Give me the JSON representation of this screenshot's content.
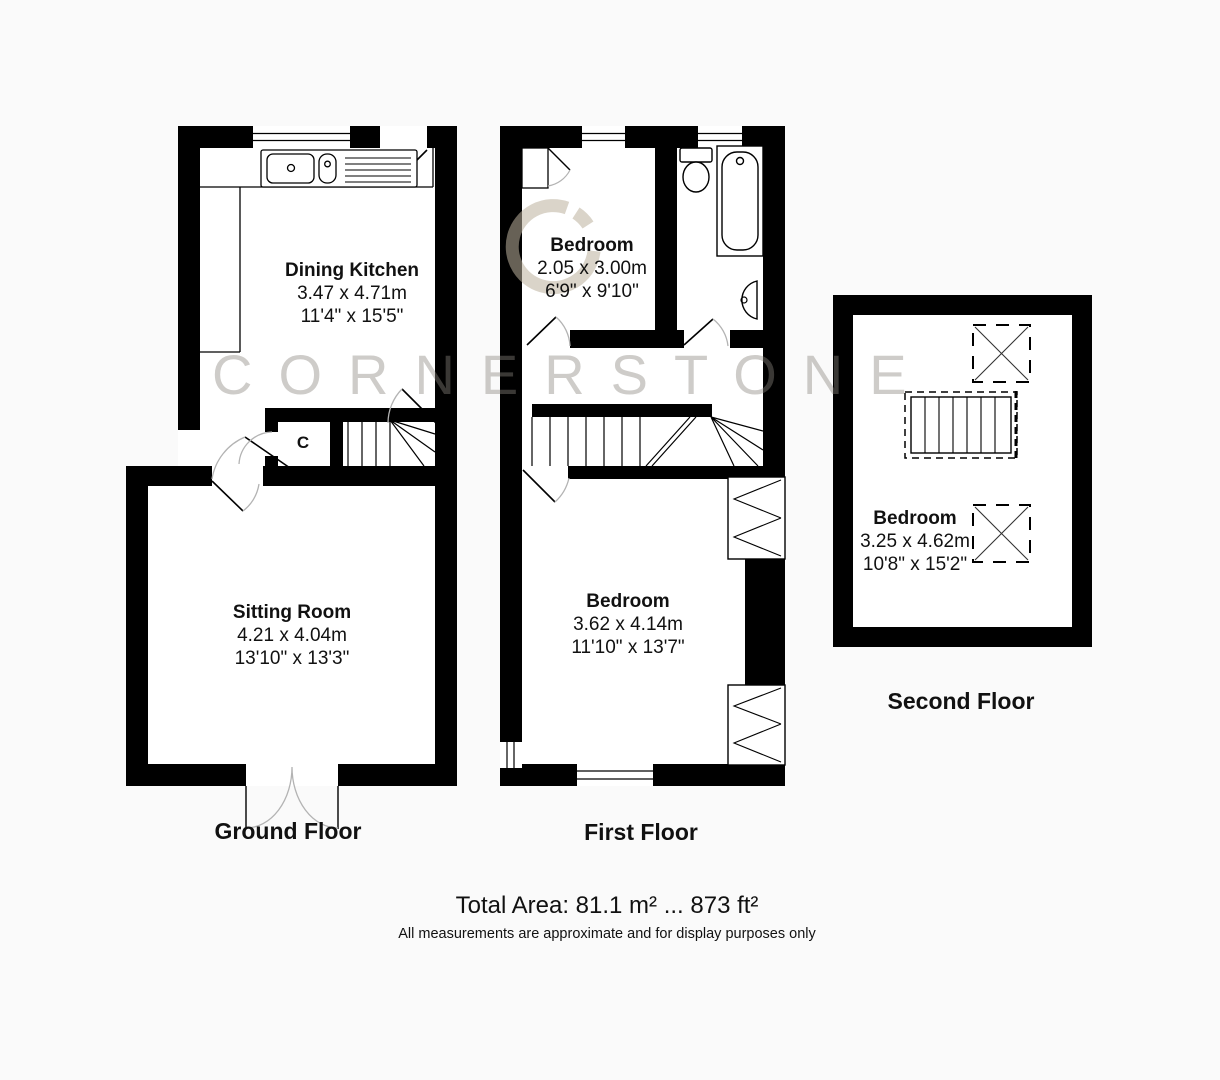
{
  "watermark": {
    "text": "CORNERSTONE"
  },
  "brand_colors": {
    "watermark_gray": "#cfcdc9",
    "logo_tan": "#dbd4c8",
    "wall_black": "#000000"
  },
  "floors": {
    "ground": {
      "title": "Ground Floor",
      "closet_label": "C",
      "rooms": [
        {
          "name": "Dining Kitchen",
          "metric": "3.47 x 4.71m",
          "imperial": "11'4\" x 15'5\""
        },
        {
          "name": "Sitting Room",
          "metric": "4.21 x 4.04m",
          "imperial": "13'10\" x 13'3\""
        }
      ]
    },
    "first": {
      "title": "First Floor",
      "rooms": [
        {
          "name": "Bedroom",
          "metric": "2.05 x 3.00m",
          "imperial": "6'9\" x 9'10\""
        },
        {
          "name": "Bedroom",
          "metric": "3.62 x 4.14m",
          "imperial": "11'10\" x 13'7\""
        }
      ]
    },
    "second": {
      "title": "Second Floor",
      "rooms": [
        {
          "name": "Bedroom",
          "metric": "3.25 x 4.62m",
          "imperial": "10'8\" x 15'2\""
        }
      ]
    }
  },
  "footer": {
    "total_area": "Total Area: 81.1 m² ... 873 ft²",
    "disclaimer": "All measurements are approximate and for display purposes only"
  }
}
